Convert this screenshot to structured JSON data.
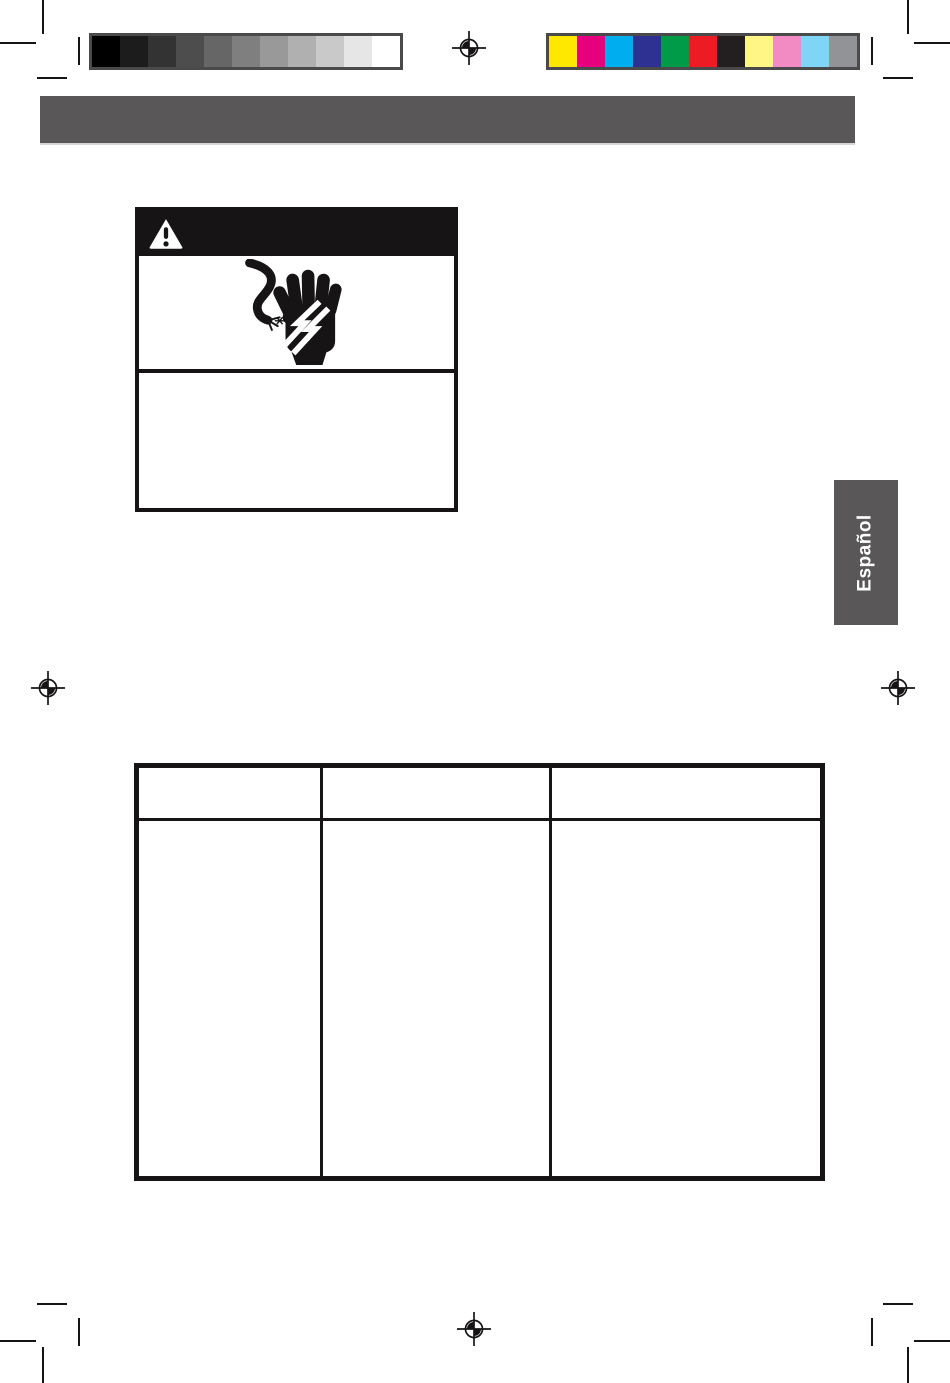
{
  "document": {
    "kind": "instruction-manual-page-proof",
    "language_tab_label": "Español"
  },
  "header_bar": {
    "text": "",
    "background": "#595757"
  },
  "language_tab": {
    "background": "#595757",
    "text_color": "#ffffff"
  },
  "calibration": {
    "grayscale_swatches": [
      "#000000",
      "#1c1c1c",
      "#333333",
      "#4d4d4d",
      "#666666",
      "#7f7f7f",
      "#999999",
      "#b0b0b0",
      "#c9c9c9",
      "#e6e6e6",
      "#ffffff"
    ],
    "color_swatches": [
      "#ffe800",
      "#e6007e",
      "#00aeef",
      "#2e3192",
      "#009b48",
      "#ed1c24",
      "#231f20",
      "#fff685",
      "#f28bc4",
      "#7fd5f6",
      "#919396"
    ]
  },
  "warning_panel": {
    "band_background": "#161414",
    "band_text": "",
    "icons": [
      "warning-triangle-icon",
      "electric-shock-hand-icon"
    ],
    "body_text": ""
  },
  "table": {
    "column_count": 3,
    "header_labels": [
      "",
      "",
      ""
    ]
  },
  "ink_color": "#161414"
}
